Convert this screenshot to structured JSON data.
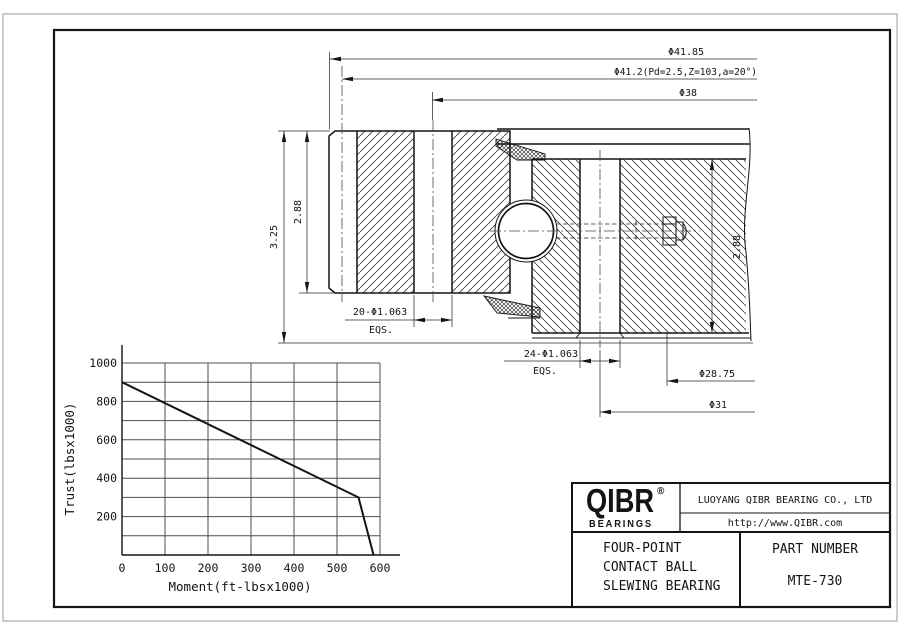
{
  "drawing": {
    "dims": {
      "outer_diameter": "Φ41.85",
      "gear_pitch": "Φ41.2(Pd=2.5,Z=103,a=20°)",
      "bolt_circle_outer": "Φ38",
      "holes_outer": "20-Φ1.063",
      "holes_outer_eqs": "EQS.",
      "holes_inner": "24-Φ1.063",
      "holes_inner_eqs": "EQS.",
      "inner_diameter_1": "Φ28.75",
      "bolt_circle_inner": "Φ31",
      "overall_height": "3.25",
      "outer_ring_height": "2.88",
      "inner_ring_height": "2.88"
    }
  },
  "chart_data": {
    "type": "line",
    "xlabel": "Moment(ft-lbsx1000)",
    "ylabel": "Trust(lbsx1000)",
    "xlim": [
      0,
      600
    ],
    "ylim": [
      0,
      1000
    ],
    "grid_step": 100,
    "x_ticks": [
      0,
      100,
      200,
      300,
      400,
      500,
      600
    ],
    "y_ticks": [
      200,
      400,
      600,
      800,
      1000
    ],
    "legend": "none",
    "grid": "on",
    "series": [
      {
        "name": "static load capacity limit",
        "points": [
          [
            0,
            900
          ],
          [
            550,
            300
          ],
          [
            585,
            0
          ]
        ]
      }
    ]
  },
  "title_block": {
    "logo_text": "QIBR",
    "logo_reg": "®",
    "logo_sub": "BEARINGS",
    "company": "LUOYANG QIBR BEARING CO., LTD",
    "website": "http://www.QIBR.com",
    "product_line1": "FOUR-POINT",
    "product_line2": "CONTACT BALL",
    "product_line3": "SLEWING BEARING",
    "part_label": "PART NUMBER",
    "part_number": "MTE-730"
  }
}
